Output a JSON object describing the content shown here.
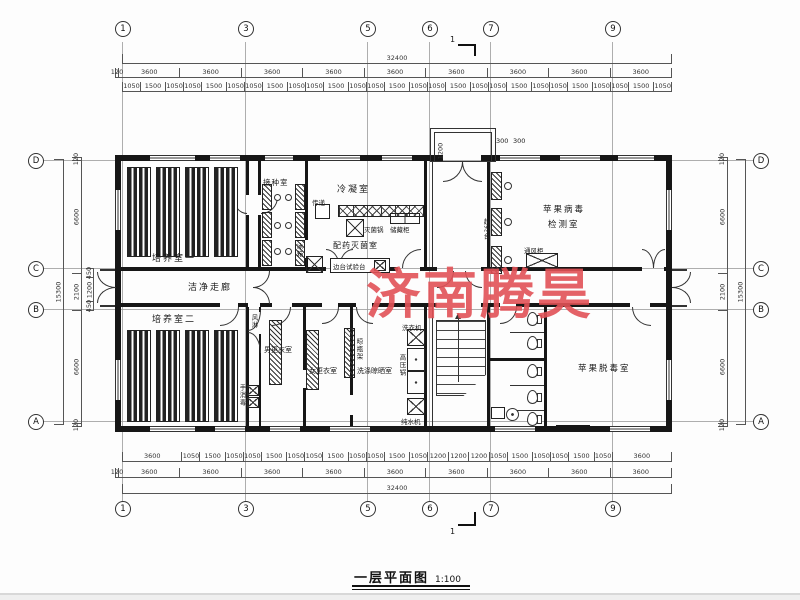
{
  "page": {
    "title": "一层平面图",
    "scale": "1:100",
    "watermark": "济南腾昊",
    "watermark_color": "#e25257",
    "section_mark": "1"
  },
  "grid": {
    "cols": [
      "1",
      "3",
      "5",
      "6",
      "7",
      "9"
    ],
    "rows": [
      "D",
      "C",
      "B",
      "A"
    ]
  },
  "dims": {
    "total_h": "32400",
    "total_v": "15300",
    "top_spans": [
      120,
      3600,
      3600,
      3600,
      3600,
      3600,
      3600,
      3600,
      3600,
      3600
    ],
    "top_fine": [
      1050,
      1500,
      1050,
      1050,
      1500,
      1050,
      1050,
      1500,
      1050,
      1050,
      1500,
      1050,
      1050,
      1500,
      1050,
      1050,
      1500,
      1050,
      1050,
      1500,
      1050,
      1050,
      1500,
      1050,
      1050,
      1500,
      1050
    ],
    "bottom_fine": [
      3600,
      1050,
      1500,
      1050,
      1050,
      1500,
      1050,
      1050,
      1500,
      1050,
      1050,
      1500,
      1050,
      1200,
      1200,
      1200,
      1050,
      1500,
      1050,
      1050,
      1500,
      1050,
      3600
    ],
    "bottom_spans": [
      120,
      3600,
      3600,
      3600,
      3600,
      3600,
      3600,
      3600,
      3600,
      3600
    ],
    "left_col": [
      120,
      6600,
      2100,
      6600,
      120
    ],
    "left_sub": [
      450,
      1200,
      450
    ],
    "right_col": [
      120,
      6600,
      2100,
      6600,
      120
    ],
    "entrance": {
      "depth": "1200",
      "a": "300",
      "b": "300"
    }
  },
  "rooms": {
    "peiyang1": "培养室一",
    "jiezhong": "接种室",
    "lengning": "冷凝室",
    "peiyao": "配药灭菌室",
    "jiance1": "苹果病毒",
    "jiance2": "检测室",
    "corridor": "洁净走廊",
    "peiyang2": "培养室二",
    "nan": "男更衣室",
    "nv": "女更衣室",
    "xidi": "洗涤晾晒室",
    "tuodu": "苹果脱毒室"
  },
  "equipment": {
    "chuandi": "传递",
    "miejun": "灭菌锅",
    "chucang": "储藏柜",
    "biantai": "边台试验台",
    "bingxiang": "冰箱",
    "chaojing": "超净台",
    "tongfeng": "通风柜",
    "fenglin": "风淋",
    "shouxiao": "手消毒",
    "liangping": "晾瓶架",
    "xiyi": "洗衣机",
    "gaoya": "高压锅",
    "chunshui": "纯水机"
  }
}
